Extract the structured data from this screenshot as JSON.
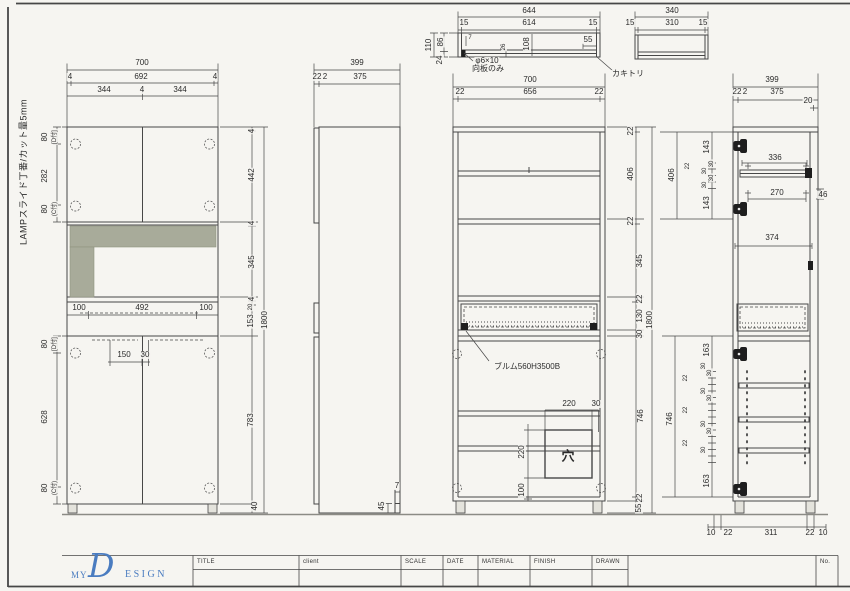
{
  "sheet": {
    "paper_color": "#f6f5f1",
    "line_color": "#474747",
    "shade_color": "#a8ab9a",
    "logo_blue": "#4a7cc0"
  },
  "logo": {
    "my": "MY",
    "d": "D",
    "esign": "ESIGN"
  },
  "title_block": {
    "fields": [
      "TITLE",
      "client",
      "SCALE",
      "DATE",
      "MATERIAL",
      "FINISH",
      "DRAWN"
    ],
    "no_label": "No."
  },
  "labels": [
    {
      "t": "LAMPスライド丁番/カット量5mm",
      "x": 24,
      "y": 172,
      "r": 1,
      "c": "jp9",
      "n": "hinge-note"
    },
    {
      "t": "700",
      "x": 142,
      "y": 63
    },
    {
      "t": "4",
      "x": 70,
      "y": 77
    },
    {
      "t": "692",
      "x": 141,
      "y": 77
    },
    {
      "t": "4",
      "x": 215,
      "y": 77
    },
    {
      "t": "344",
      "x": 104,
      "y": 90
    },
    {
      "t": "4",
      "x": 142,
      "y": 90
    },
    {
      "t": "344",
      "x": 180,
      "y": 90
    },
    {
      "t": "80",
      "x": 45,
      "y": 137,
      "r": 1
    },
    {
      "t": "[D付]",
      "x": 55,
      "y": 137,
      "r": 1,
      "c": "c6"
    },
    {
      "t": "282",
      "x": 45,
      "y": 176,
      "r": 1
    },
    {
      "t": "80",
      "x": 45,
      "y": 209,
      "r": 1
    },
    {
      "t": "(C付)",
      "x": 55,
      "y": 209,
      "r": 1,
      "c": "c6"
    },
    {
      "t": "80",
      "x": 45,
      "y": 344,
      "r": 1
    },
    {
      "t": "[D付]",
      "x": 55,
      "y": 344,
      "r": 1,
      "c": "c6"
    },
    {
      "t": "628",
      "x": 45,
      "y": 417,
      "r": 1
    },
    {
      "t": "80",
      "x": 45,
      "y": 488,
      "r": 1
    },
    {
      "t": "(C付)",
      "x": 55,
      "y": 488,
      "r": 1,
      "c": "c6"
    },
    {
      "t": "100",
      "x": 79,
      "y": 308
    },
    {
      "t": "492",
      "x": 142,
      "y": 308
    },
    {
      "t": "100",
      "x": 206,
      "y": 308
    },
    {
      "t": "150",
      "x": 124,
      "y": 355
    },
    {
      "t": "30",
      "x": 145,
      "y": 355
    },
    {
      "t": "4",
      "x": 252,
      "y": 131,
      "r": 1
    },
    {
      "t": "442",
      "x": 252,
      "y": 175,
      "r": 1
    },
    {
      "t": "4",
      "x": 252,
      "y": 223,
      "r": 1
    },
    {
      "t": "345",
      "x": 252,
      "y": 262,
      "r": 1
    },
    {
      "t": "4",
      "x": 252,
      "y": 299,
      "r": 1
    },
    {
      "t": "20",
      "x": 251,
      "y": 307,
      "r": 1,
      "c": "c6"
    },
    {
      "t": "153",
      "x": 251,
      "y": 321,
      "r": 1
    },
    {
      "t": "783",
      "x": 251,
      "y": 420,
      "r": 1
    },
    {
      "t": "40",
      "x": 255,
      "y": 506,
      "r": 1
    },
    {
      "t": "1800",
      "x": 265,
      "y": 320,
      "r": 1
    },
    {
      "t": "399",
      "x": 357,
      "y": 63
    },
    {
      "t": "22",
      "x": 317,
      "y": 77
    },
    {
      "t": "2",
      "x": 325,
      "y": 77
    },
    {
      "t": "375",
      "x": 360,
      "y": 77
    },
    {
      "t": "45",
      "x": 382,
      "y": 506,
      "r": 1
    },
    {
      "t": "7",
      "x": 397,
      "y": 486
    },
    {
      "t": "644",
      "x": 529,
      "y": 11
    },
    {
      "t": "15",
      "x": 464,
      "y": 23
    },
    {
      "t": "614",
      "x": 529,
      "y": 23
    },
    {
      "t": "15",
      "x": 593,
      "y": 23
    },
    {
      "t": "110",
      "x": 429,
      "y": 45,
      "r": 1
    },
    {
      "t": "86",
      "x": 441,
      "y": 42,
      "r": 1
    },
    {
      "t": "24",
      "x": 440,
      "y": 60,
      "r": 1
    },
    {
      "t": "7",
      "x": 470,
      "y": 38,
      "c": "c6"
    },
    {
      "t": "26",
      "x": 504,
      "y": 47,
      "r": 1,
      "c": "c6"
    },
    {
      "t": "108",
      "x": 527,
      "y": 44,
      "r": 1
    },
    {
      "t": "55",
      "x": 588,
      "y": 40
    },
    {
      "t": "φ6×10",
      "x": 487,
      "y": 61,
      "c": "jp",
      "n": "hole-note"
    },
    {
      "t": "向板のみ",
      "x": 488,
      "y": 69,
      "c": "jp",
      "n": "backboard-note"
    },
    {
      "t": "カキトリ",
      "x": 628,
      "y": 74,
      "c": "jp",
      "n": "notch-note"
    },
    {
      "t": "340",
      "x": 672,
      "y": 11
    },
    {
      "t": "15",
      "x": 630,
      "y": 23
    },
    {
      "t": "310",
      "x": 672,
      "y": 23
    },
    {
      "t": "15",
      "x": 703,
      "y": 23
    },
    {
      "t": "700",
      "x": 530,
      "y": 80
    },
    {
      "t": "22",
      "x": 460,
      "y": 92
    },
    {
      "t": "656",
      "x": 530,
      "y": 92
    },
    {
      "t": "22",
      "x": 599,
      "y": 92
    },
    {
      "t": "22",
      "x": 631,
      "y": 131,
      "r": 1
    },
    {
      "t": "406",
      "x": 631,
      "y": 174,
      "r": 1
    },
    {
      "t": "22",
      "x": 631,
      "y": 221,
      "r": 1
    },
    {
      "t": "345",
      "x": 640,
      "y": 261,
      "r": 1
    },
    {
      "t": "22",
      "x": 640,
      "y": 299,
      "r": 1
    },
    {
      "t": "130",
      "x": 640,
      "y": 316,
      "r": 1
    },
    {
      "t": "30",
      "x": 640,
      "y": 334,
      "r": 1
    },
    {
      "t": "746",
      "x": 641,
      "y": 416,
      "r": 1
    },
    {
      "t": "22",
      "x": 640,
      "y": 498,
      "r": 1
    },
    {
      "t": "55",
      "x": 639,
      "y": 508,
      "r": 1
    },
    {
      "t": "1800",
      "x": 650,
      "y": 320,
      "r": 1
    },
    {
      "t": "406",
      "x": 672,
      "y": 175,
      "r": 1
    },
    {
      "t": "22",
      "x": 688,
      "y": 166,
      "r": 1,
      "c": "c6"
    },
    {
      "t": "143",
      "x": 707,
      "y": 147,
      "r": 1
    },
    {
      "t": "30",
      "x": 712,
      "y": 164,
      "r": 1,
      "c": "c6"
    },
    {
      "t": "30",
      "x": 705,
      "y": 171,
      "r": 1,
      "c": "c6"
    },
    {
      "t": "30",
      "x": 712,
      "y": 178,
      "r": 1,
      "c": "c6"
    },
    {
      "t": "30",
      "x": 705,
      "y": 185,
      "r": 1,
      "c": "c6"
    },
    {
      "t": "143",
      "x": 707,
      "y": 203,
      "r": 1
    },
    {
      "t": "ブルム560H3500B",
      "x": 527,
      "y": 367,
      "c": "jp",
      "n": "blum-note"
    },
    {
      "t": "220",
      "x": 569,
      "y": 404
    },
    {
      "t": "30",
      "x": 596,
      "y": 404
    },
    {
      "t": "220",
      "x": 522,
      "y": 452,
      "r": 1
    },
    {
      "t": "100",
      "x": 522,
      "y": 490,
      "r": 1
    },
    {
      "t": "穴",
      "x": 568,
      "y": 456,
      "c": "big",
      "n": "hole-mark"
    },
    {
      "t": "399",
      "x": 772,
      "y": 80
    },
    {
      "t": "22",
      "x": 737,
      "y": 92
    },
    {
      "t": "2",
      "x": 745,
      "y": 92
    },
    {
      "t": "375",
      "x": 777,
      "y": 92
    },
    {
      "t": "20",
      "x": 808,
      "y": 101
    },
    {
      "t": "336",
      "x": 775,
      "y": 158
    },
    {
      "t": "270",
      "x": 777,
      "y": 193
    },
    {
      "t": "46",
      "x": 823,
      "y": 195
    },
    {
      "t": "374",
      "x": 772,
      "y": 238
    },
    {
      "t": "746",
      "x": 670,
      "y": 419,
      "r": 1
    },
    {
      "t": "163",
      "x": 707,
      "y": 350,
      "r": 1
    },
    {
      "t": "30",
      "x": 704,
      "y": 366,
      "r": 1,
      "c": "c6"
    },
    {
      "t": "30",
      "x": 710,
      "y": 373,
      "r": 1,
      "c": "c6"
    },
    {
      "t": "22",
      "x": 686,
      "y": 378,
      "r": 1,
      "c": "c6"
    },
    {
      "t": "30",
      "x": 704,
      "y": 391,
      "r": 1,
      "c": "c6"
    },
    {
      "t": "30",
      "x": 710,
      "y": 398,
      "r": 1,
      "c": "c6"
    },
    {
      "t": "22",
      "x": 686,
      "y": 410,
      "r": 1,
      "c": "c6"
    },
    {
      "t": "30",
      "x": 704,
      "y": 424,
      "r": 1,
      "c": "c6"
    },
    {
      "t": "30",
      "x": 710,
      "y": 431,
      "r": 1,
      "c": "c6"
    },
    {
      "t": "22",
      "x": 686,
      "y": 443,
      "r": 1,
      "c": "c6"
    },
    {
      "t": "30",
      "x": 704,
      "y": 450,
      "r": 1,
      "c": "c6"
    },
    {
      "t": "163",
      "x": 707,
      "y": 481,
      "r": 1
    },
    {
      "t": "10",
      "x": 711,
      "y": 533
    },
    {
      "t": "22",
      "x": 728,
      "y": 533
    },
    {
      "t": "311",
      "x": 771,
      "y": 533
    },
    {
      "t": "22",
      "x": 810,
      "y": 533
    },
    {
      "t": "10",
      "x": 823,
      "y": 533
    }
  ]
}
